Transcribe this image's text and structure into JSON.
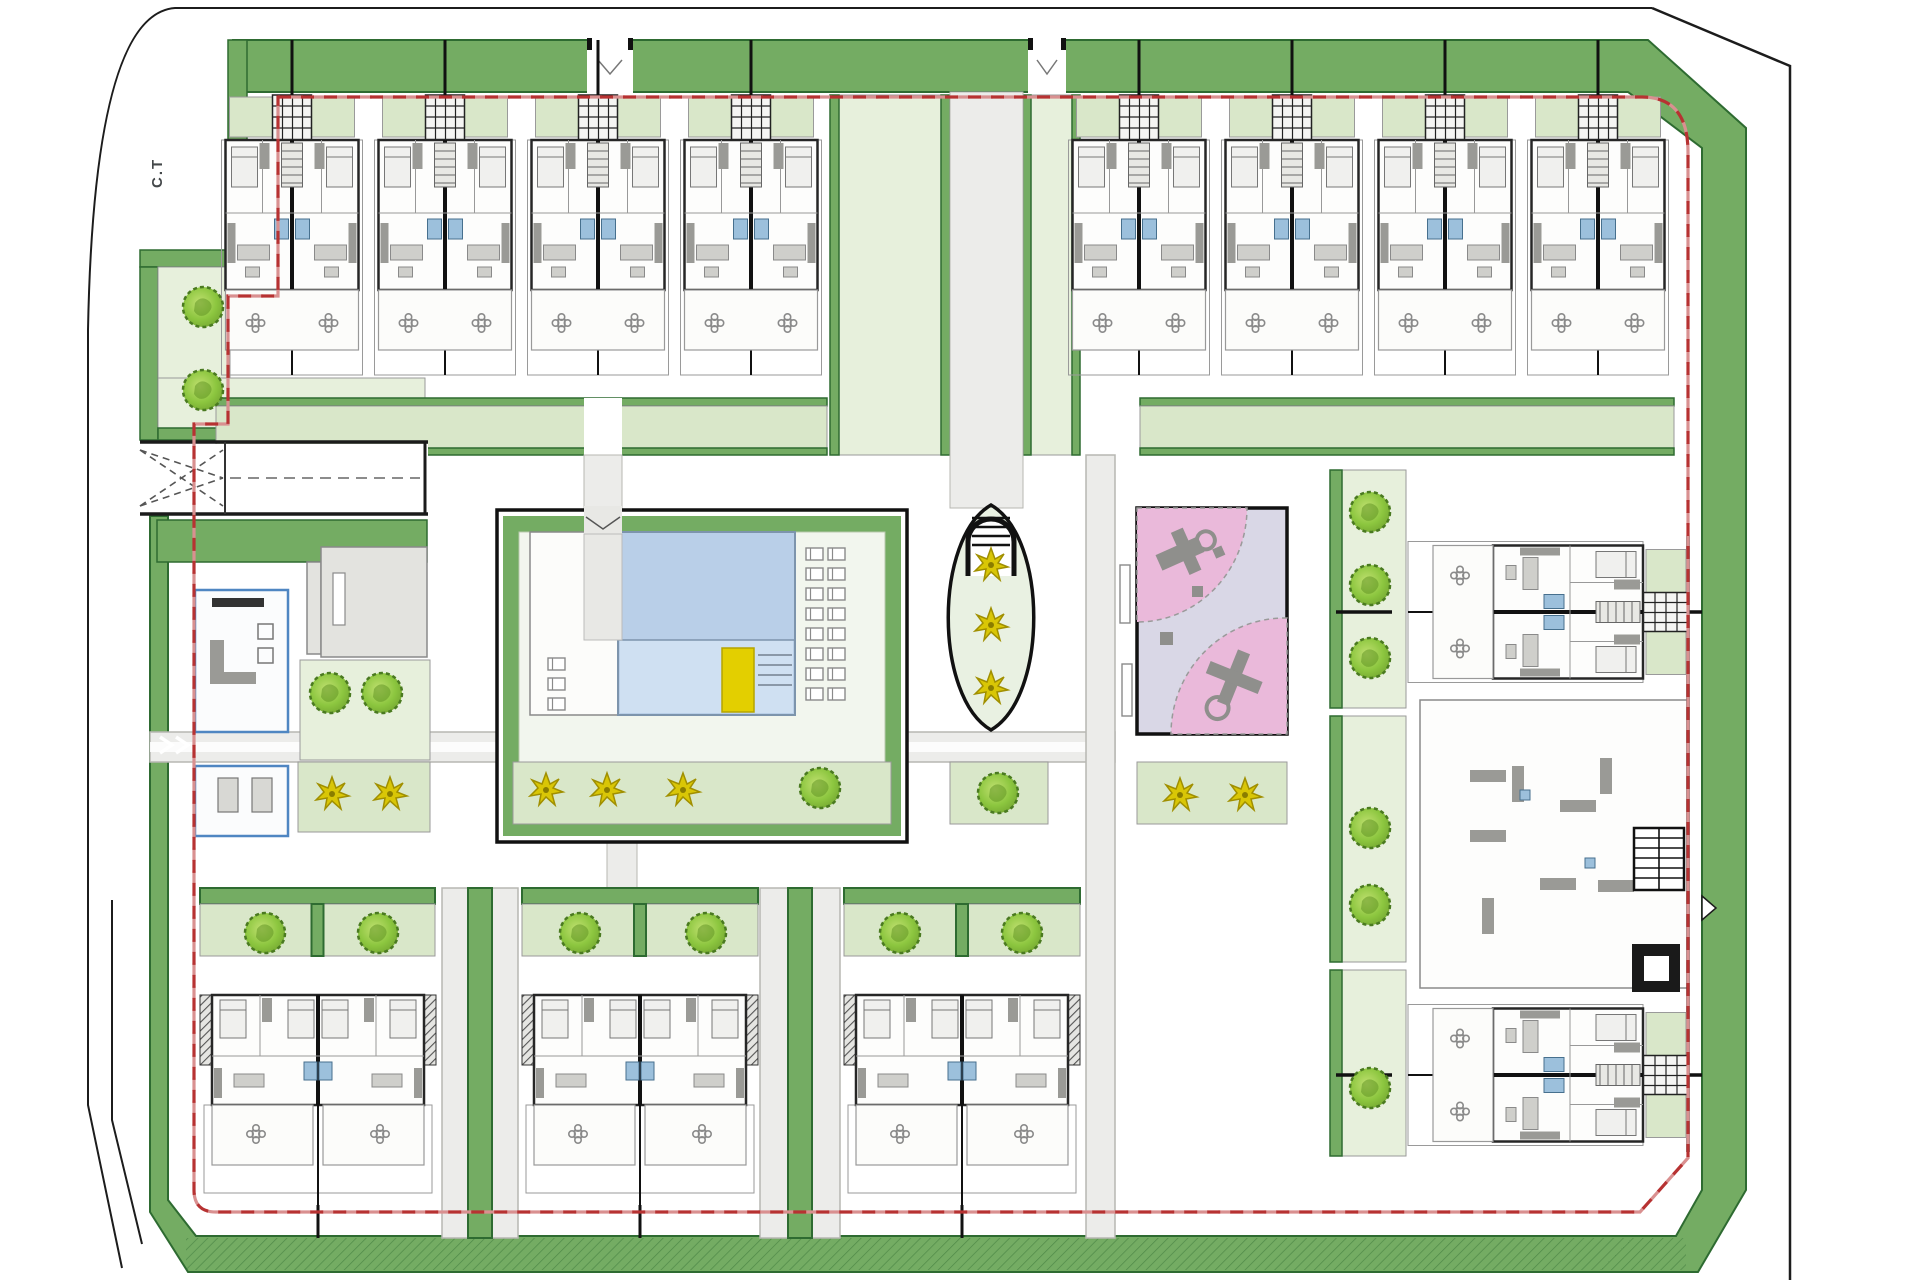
{
  "labels": {
    "transformer": "C.T"
  },
  "colors": {
    "band": "#74ac63",
    "bandDark": "#2e6b31",
    "lg": "#d9e7c9",
    "lgLight": "#e7f0dc",
    "road": "#ececea",
    "roadEdge": "#b7b7b2",
    "wall": "#262626",
    "grayline": "#9a9a9a",
    "furn": "#9a9a96",
    "furnL": "#cfcfcb",
    "bath": "#9cc0dc",
    "bathEdge": "#47708e",
    "poolDeep": "#b9cfe8",
    "poolLight": "#cfe0f2",
    "poolEdge": "#7d94ac",
    "red": "#b73232",
    "redLight": "#d99090",
    "pink": "#eab9da",
    "lavender": "#d9d7e6",
    "equip": "#8f8f8c",
    "tree": "#8cc63f",
    "treeLight": "#b5dc62",
    "treeEdge": "#4a7a20",
    "palm": "#d9c606",
    "palmEdge": "#a08f00",
    "mat": "#e3cf00",
    "clubEdge": "#4f86c2"
  },
  "plan": {
    "trees": [
      [
        203,
        307
      ],
      [
        203,
        390
      ],
      [
        330,
        693
      ],
      [
        382,
        693
      ],
      [
        820,
        788
      ],
      [
        998,
        793
      ],
      [
        265,
        933
      ],
      [
        378,
        933
      ],
      [
        580,
        933
      ],
      [
        706,
        933
      ],
      [
        900,
        933
      ],
      [
        1022,
        933
      ],
      [
        1370,
        512
      ],
      [
        1370,
        585
      ],
      [
        1370,
        658
      ],
      [
        1370,
        828
      ],
      [
        1370,
        905
      ],
      [
        1370,
        1088
      ]
    ],
    "palms": [
      [
        546,
        790
      ],
      [
        607,
        790
      ],
      [
        683,
        790
      ],
      [
        332,
        794
      ],
      [
        390,
        794
      ],
      [
        991,
        565
      ],
      [
        991,
        625
      ],
      [
        991,
        688
      ],
      [
        1180,
        795
      ],
      [
        1245,
        795
      ]
    ],
    "loungers_left": [
      [
        548,
        658
      ],
      [
        548,
        678
      ],
      [
        548,
        698
      ]
    ],
    "loungers_right_cols": [
      806,
      828
    ],
    "loungers_right_rows": [
      548,
      568,
      588,
      608,
      628,
      648,
      668,
      688
    ],
    "top_pair_axes": [
      292,
      445,
      598,
      751,
      1139,
      1292,
      1445,
      1598
    ],
    "bottom_pair_axes": [
      318,
      640,
      962
    ],
    "right_pair_axes_y": [
      612,
      1075
    ],
    "bottom_planters": [
      [
        200,
        235
      ],
      [
        522,
        236
      ],
      [
        844,
        236
      ]
    ],
    "unit_counts": {
      "top_row_pairs": 8,
      "bottom_row_pairs": 3,
      "right_block_pairs": 2
    }
  }
}
